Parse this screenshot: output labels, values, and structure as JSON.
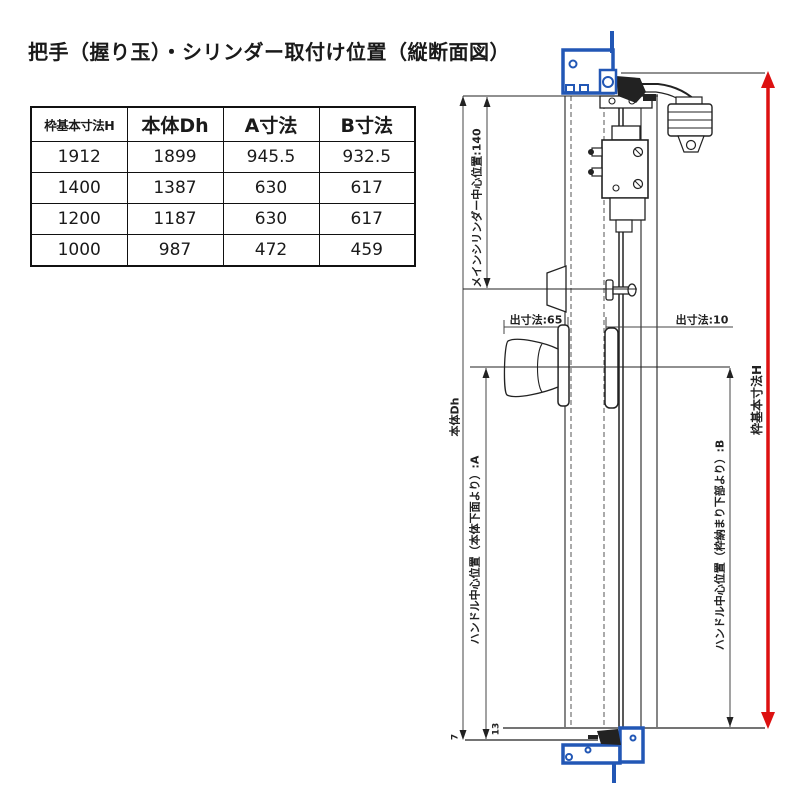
{
  "title": "把手（握り玉）・シリンダー取付け位置（縦断面図）",
  "table": {
    "headers": [
      "枠基本寸法H",
      "本体Dh",
      "A寸法",
      "B寸法"
    ],
    "rows": [
      [
        "1912",
        "1899",
        "945.5",
        "932.5"
      ],
      [
        "1400",
        "1387",
        "630",
        "617"
      ],
      [
        "1200",
        "1187",
        "630",
        "617"
      ],
      [
        "1000",
        "987",
        "472",
        "459"
      ]
    ]
  },
  "diagram": {
    "labels": {
      "main_cylinder_center": "メインシリンダー中心位置:140",
      "protrusion_left": "出寸法:65",
      "protrusion_right": "出寸法:10",
      "body_dh": "本体Dh",
      "handle_center_a": "ハンドル中心位置（本体下面より）:A",
      "frame_h": "枠基本寸法H",
      "handle_center_b": "ハンドル中心位置（枠納まり下部より）:B",
      "dim_13": "13",
      "dim_7": "7"
    },
    "colors": {
      "frame_blue": "#2257b5",
      "dimension_red": "#dd1111",
      "line_black": "#222222"
    }
  }
}
